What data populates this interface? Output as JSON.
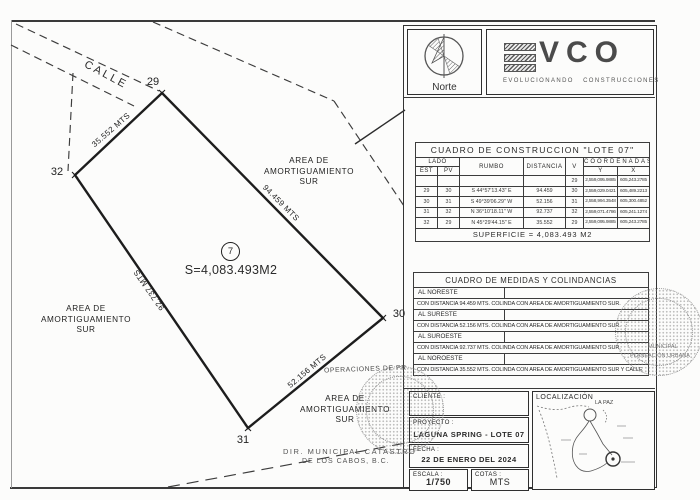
{
  "drawing": {
    "street_label": "CALLE",
    "vertex_labels": {
      "v29": "29",
      "v30": "30",
      "v31": "31",
      "v32": "32"
    },
    "side_labels": {
      "nw": "35.552 MTS",
      "ne": "94.459 MTS",
      "se": "52.156 MTS",
      "sw": "92.737 MTS"
    },
    "lot_number": "7",
    "area_text": "S=4,083.493M2",
    "buffer_area_right": "AREA DE\nAMORTIGUAMIENTO\nSUR",
    "buffer_area_left": "AREA DE\nAMORTIGUAMIENTO\nSUR",
    "buffer_area_bottom": "AREA DE\nAMORTIGUAMIENTO\nSUR"
  },
  "branding": {
    "norte_label": "Norte",
    "evco_letters": "VCO",
    "evco_subtitle": "EVOLUCIONANDO   CONSTRUCCIONES"
  },
  "construction_table": {
    "title": "CUADRO DE CONSTRUCCION \"LOTE 07\"",
    "headers": {
      "lado": "LADO",
      "est": "EST",
      "pv": "PV",
      "rumbo": "RUMBO",
      "distancia": "DISTANCIA",
      "v": "V",
      "coordenadas": "COORDENADAS",
      "y": "Y",
      "x": "X"
    },
    "rows": [
      {
        "est": "",
        "pv": "",
        "rumbo": "",
        "dist": "",
        "v": "29",
        "y": "2,559,095.9885",
        "x": "605,243.2785"
      },
      {
        "est": "29",
        "pv": "30",
        "rumbo": "S 44°57'13.43\" E",
        "dist": "94.459",
        "v": "30",
        "y": "2,559,029.0421",
        "x": "605,489.2213"
      },
      {
        "est": "30",
        "pv": "31",
        "rumbo": "S 49°39'06.29\" W",
        "dist": "52.156",
        "v": "31",
        "y": "2,558,994.3548",
        "x": "605,300.4852"
      },
      {
        "est": "31",
        "pv": "32",
        "rumbo": "N 36°10'18.11\" W",
        "dist": "92.737",
        "v": "32",
        "y": "2,559,071.4786",
        "x": "605,241.1274"
      },
      {
        "est": "32",
        "pv": "29",
        "rumbo": "N 45°29'44.15\" E",
        "dist": "35.552",
        "v": "29",
        "y": "2,559,095.9885",
        "x": "605,243.2785"
      }
    ],
    "footer": "SUPERFICIE = 4,083.493 M2"
  },
  "colindancias_table": {
    "title": "CUADRO DE MEDIDAS Y COLINDANCIAS",
    "entries": [
      {
        "heading": "AL NORESTE",
        "detail": "CON DISTANCIA 94.459 MTS. COLINDA CON AREA DE AMORTIGUAMIENTO SUR."
      },
      {
        "heading": "AL SURESTE",
        "detail": "CON DISTANCIA 52.156 MTS. COLINDA CON AREA DE AMORTIGUAMIENTO SUR."
      },
      {
        "heading": "AL SUROESTE",
        "detail": "CON DISTANCIA 92.737 MTS. COLINDA CON AREA DE AMORTIGUAMIENTO SUR."
      },
      {
        "heading": "AL NOROESTE",
        "detail": "CON DISTANCIA 35.552 MTS. COLINDA CON AREA DE AMORTIGUAMIENTO SUR Y CALLE"
      }
    ]
  },
  "title_block": {
    "cliente_label": "CLIENTE :",
    "proyecto_label": "PROYECTO :",
    "proyecto_value": "LAGUNA SPRING - LOTE 07",
    "fecha_label": "FECHA :",
    "fecha_value": "22 DE ENERO DEL 2024",
    "escala_label": "ESCALA :",
    "escala_value": "1/750",
    "cotas_label": "COTAS :",
    "cotas_value": "MTS",
    "localizacion_label": "LOCALIZACIÓN",
    "localizacion_city": "LA PAZ"
  },
  "stamps": {
    "operaciones_text": "OPERACIONES DE PR",
    "catastro_line1": "DIR. MUNICIPAL CATASTRO",
    "catastro_line2": "DE LOS CABOS, B.C.",
    "planeacion_line1": "MUNICIPAL",
    "planeacion_line2": "PLANEACIÓN URBANA"
  }
}
